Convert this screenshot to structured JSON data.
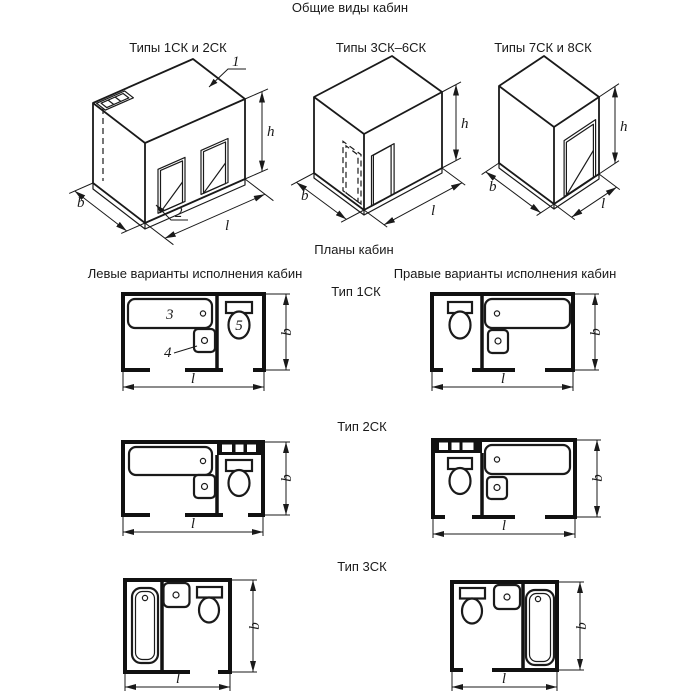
{
  "title": "Общие виды кабин",
  "general_views": {
    "label_types_1_2": "Типы 1СК и 2СК",
    "label_types_3_6": "Типы 3СК–6СК",
    "label_types_7_8": "Типы 7СК и 8СК"
  },
  "plans": {
    "title": "Планы кабин",
    "left_heading": "Левые варианты исполнения кабин",
    "right_heading": "Правые варианты исполнения кабин",
    "type1_label": "Тип 1СК",
    "type2_label": "Тип 2СК",
    "type3_label": "Тип 3СК"
  },
  "dimension_labels": {
    "height": "h",
    "depth": "b",
    "length": "l"
  },
  "callouts": {
    "cabin_body": "1",
    "base": "2",
    "bathtub": "3",
    "washbasin": "4",
    "toilet": "5"
  },
  "colors": {
    "ink": "#1a1a1a",
    "paper": "#ffffff"
  }
}
